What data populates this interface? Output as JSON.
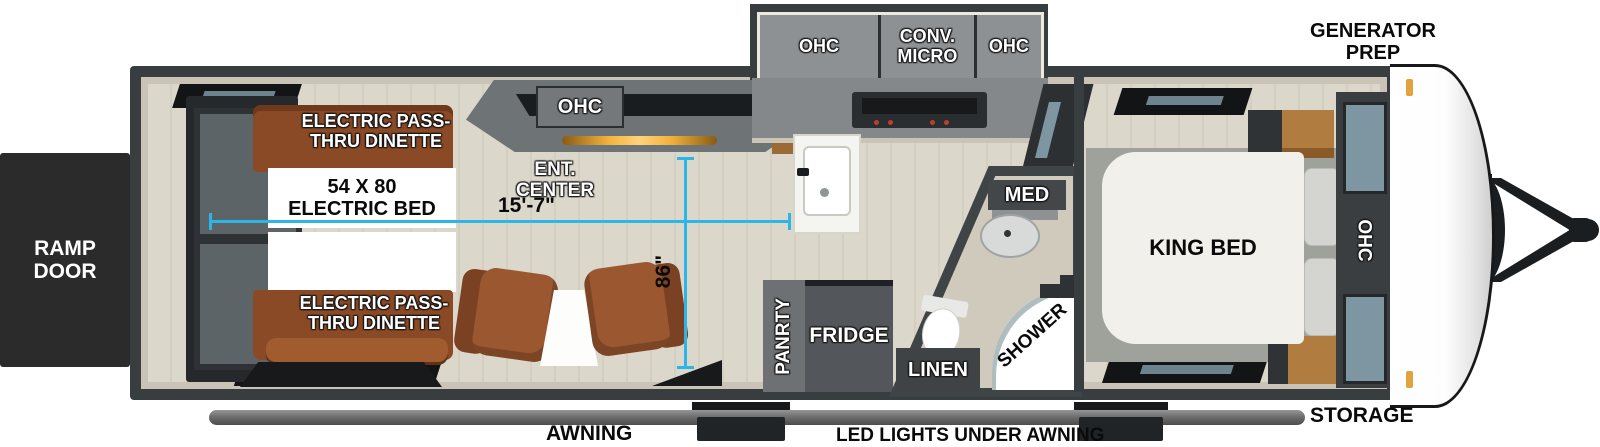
{
  "exterior": {
    "ramp_door": "RAMP DOOR",
    "generator_prep": "GENERATOR PREP",
    "awning": "AWNING",
    "led_lights": "LED LIGHTS UNDER AWNING",
    "storage": "STORAGE"
  },
  "garage": {
    "dinette_top": "ELECTRIC PASS-THRU DINETTE",
    "dinette_bottom": "ELECTRIC PASS-THRU DINETTE",
    "electric_bed": "54 X 80 ELECTRIC BED"
  },
  "living": {
    "ohc": "OHC",
    "ent_center": "ENT. CENTER"
  },
  "kitchen": {
    "ohc_left": "OHC",
    "conv_micro": "CONV. MICRO",
    "ohc_right": "OHC",
    "pantry": "PANRTY",
    "fridge": "FRIDGE"
  },
  "bathroom": {
    "med": "MED",
    "shower": "SHOWER",
    "linen": "LINEN"
  },
  "bedroom": {
    "king_bed": "KING BED",
    "ohc": "OHC"
  },
  "dimensions": {
    "interior_length": "15'-7\"",
    "interior_width": "86\""
  },
  "colors": {
    "dimension_line": "#2cb6e8",
    "wall": "#383d40",
    "interior_trim": "#c9c4b6",
    "floor": "#d9d5c8",
    "dinette_wood": "#8a4a26",
    "chair_brown": "#9a5730",
    "cabinet_gray": "#8d9194",
    "dark_cabinet": "#54585b",
    "ramp_door_bg": "#2b2b2b",
    "marker_light": "#e2a33e",
    "front_cap": "#ffffff",
    "awning_bar": "#6f6f6f"
  }
}
